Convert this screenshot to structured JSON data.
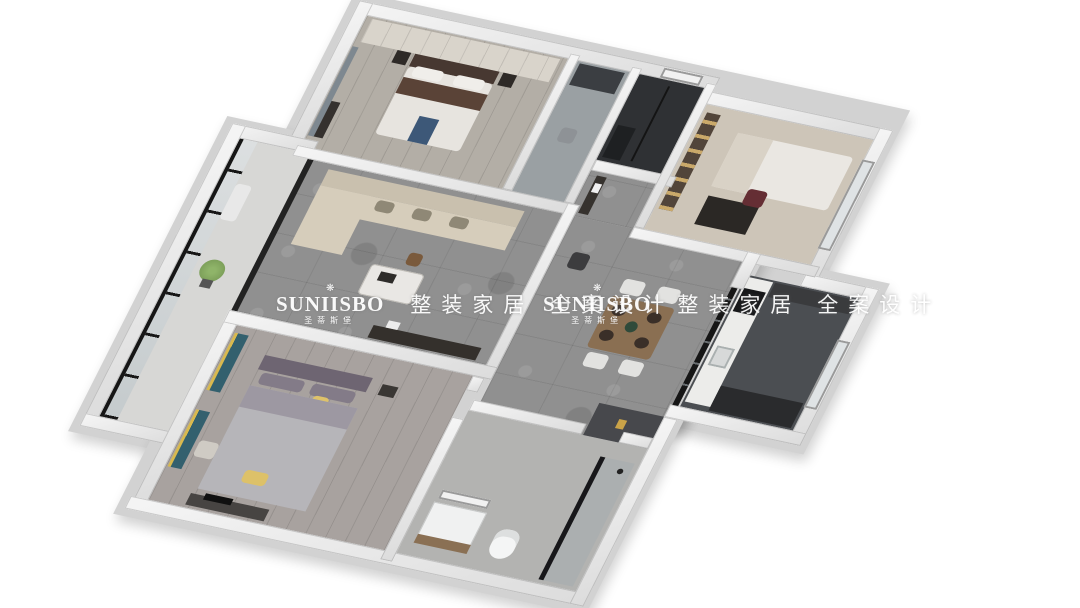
{
  "scene": {
    "description": "3D isometric dollhouse rendering of an apartment floor plan on a white background",
    "background": "#ffffff",
    "rooms": [
      "master-bedroom",
      "dressing-area",
      "dark-bathroom",
      "study-guest-room",
      "kitchen",
      "dining-hall",
      "living-room",
      "balcony",
      "second-bedroom",
      "main-bathroom"
    ]
  },
  "watermark": {
    "ornament": "❋",
    "brand": "SUNIISBO",
    "brand_cn": "圣蒂斯堡",
    "tagline": "整装家居 全案设计"
  },
  "palette": {
    "slab": "#d2d2d2",
    "wall": "#e8e8e8",
    "tileFloor": "#909090",
    "masterFloor": "#b3aea6",
    "dressFloor": "#9aa0a3",
    "bathAFloor": "#2f3134",
    "studyFloor": "#cdc5b8",
    "kitchenFloor": "#4b4e52",
    "balconyFloor": "#d7d7d5",
    "bed2Floor": "#a8a29f",
    "bath2Floor": "#b3b3b1",
    "sofaCream": "#d6cdbb",
    "woodBrown": "#8a6f52",
    "darkFurniture": "#34302c",
    "accentTeal": "#33606e",
    "accentYellow": "#dec26a",
    "accentMaroon": "#652e34",
    "accentBlue": "#3d5878",
    "glassFrame": "#161616",
    "plantGreen": "#7da05a",
    "beddingWhite": "#e7e4df"
  }
}
